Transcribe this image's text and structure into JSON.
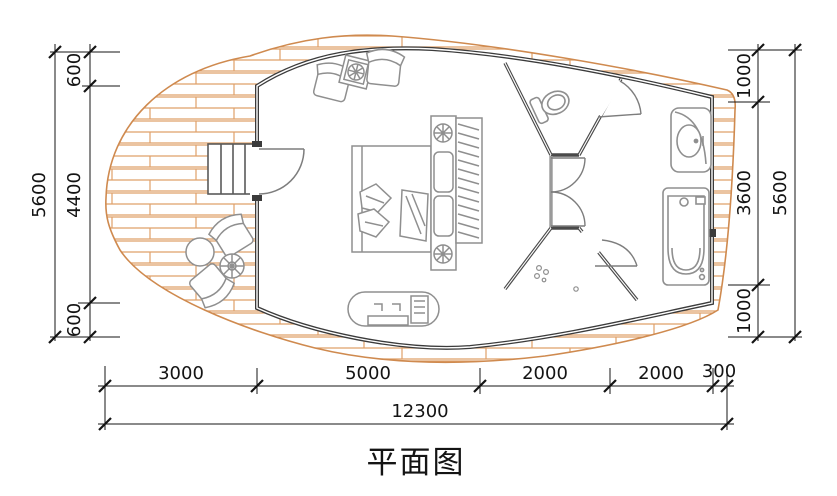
{
  "title": "平面图",
  "dimensions": {
    "left": {
      "segments": [
        "600",
        "4400",
        "600"
      ],
      "total": "5600"
    },
    "right": {
      "segments": [
        "1000",
        "3600",
        "1000"
      ],
      "total": "5600"
    },
    "bottom": {
      "segments": [
        "3000",
        "5000",
        "2000",
        "2000",
        "300"
      ],
      "total": "12300"
    }
  },
  "colors": {
    "deck_plank_line": "#dfa069",
    "deck_outline": "#cf8a4f",
    "wall": "#3b3b3b",
    "fixture": "#8f8f8f",
    "dimension": "#141414"
  }
}
